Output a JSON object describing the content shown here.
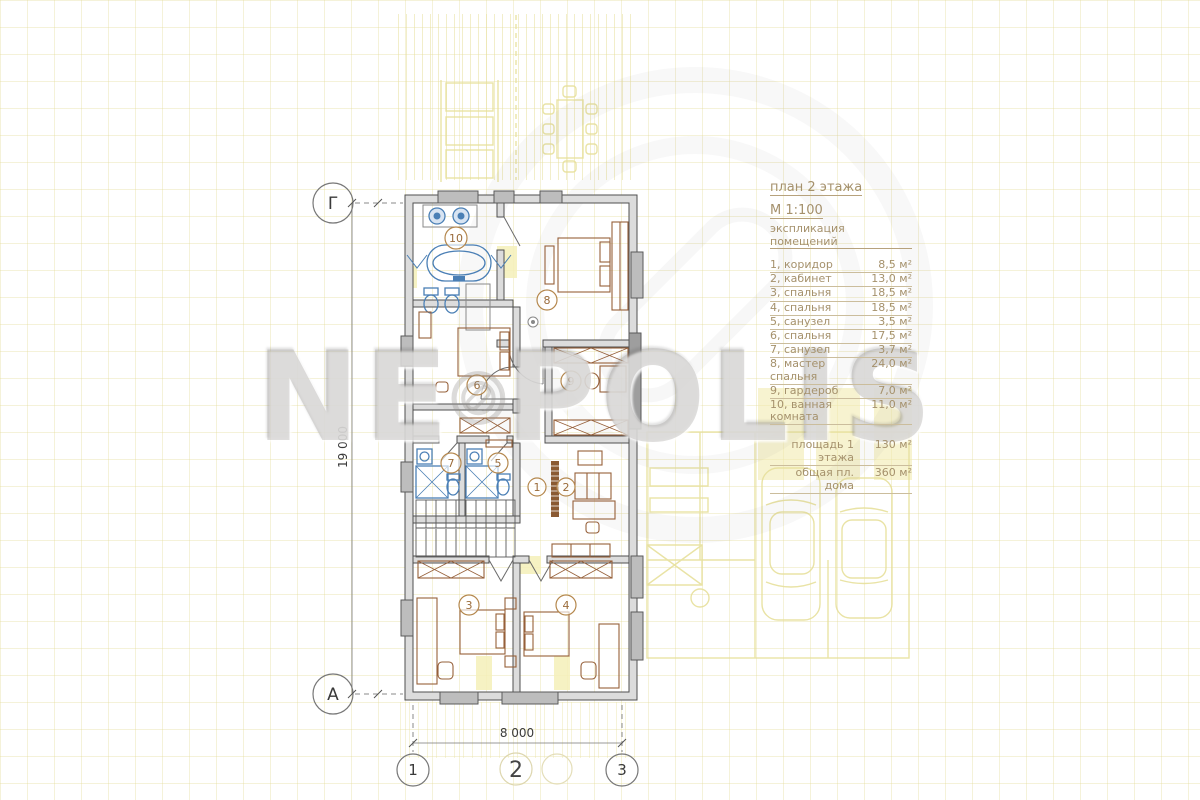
{
  "watermark": {
    "left": "NE",
    "right": "POLIS"
  },
  "title_block": {
    "title": "план 2 этажа",
    "scale": "М 1:100",
    "subtitle": "экспликация помещений"
  },
  "legend": {
    "rows": [
      {
        "label": "1, коридор",
        "area": "8,5 м²"
      },
      {
        "label": "2, кабинет",
        "area": "13,0 м²"
      },
      {
        "label": "3, спальня",
        "area": "18,5 м²"
      },
      {
        "label": "4, спальня",
        "area": "18,5 м²"
      },
      {
        "label": "5, санузел",
        "area": "3,5 м²"
      },
      {
        "label": "6, спальня",
        "area": "17,5 м²"
      },
      {
        "label": "7, санузел",
        "area": "3,7 м²"
      },
      {
        "label": "8, мастер спальня",
        "area": "24,0 м²"
      },
      {
        "label": "9, гардероб",
        "area": "7,0 м²"
      },
      {
        "label": "10, ванная комната",
        "area": "11,0 м²"
      }
    ],
    "totals": [
      {
        "label": "площадь 1 этажа",
        "value": "130 м²"
      },
      {
        "label": "общая пл. дома",
        "value": "360 м²"
      }
    ]
  },
  "axes": {
    "top_left": "Г",
    "bottom_left": "А",
    "col1": "1",
    "col2": "2",
    "col3": "3"
  },
  "dimensions": {
    "height": "19 000",
    "width": "8 000"
  },
  "plan": {
    "room_numbers": {
      "r1": "1",
      "r2": "2",
      "r3": "3",
      "r4": "4",
      "r5": "5",
      "r6": "6",
      "r7": "7",
      "r8": "8",
      "r9": "9",
      "r10": "10"
    }
  },
  "colors": {
    "wall": "#4f4f4f",
    "furniture": "#96603a",
    "sanitary": "#4a7fb5",
    "accent_text": "#a5916c",
    "underlay": "#e7e09c"
  }
}
